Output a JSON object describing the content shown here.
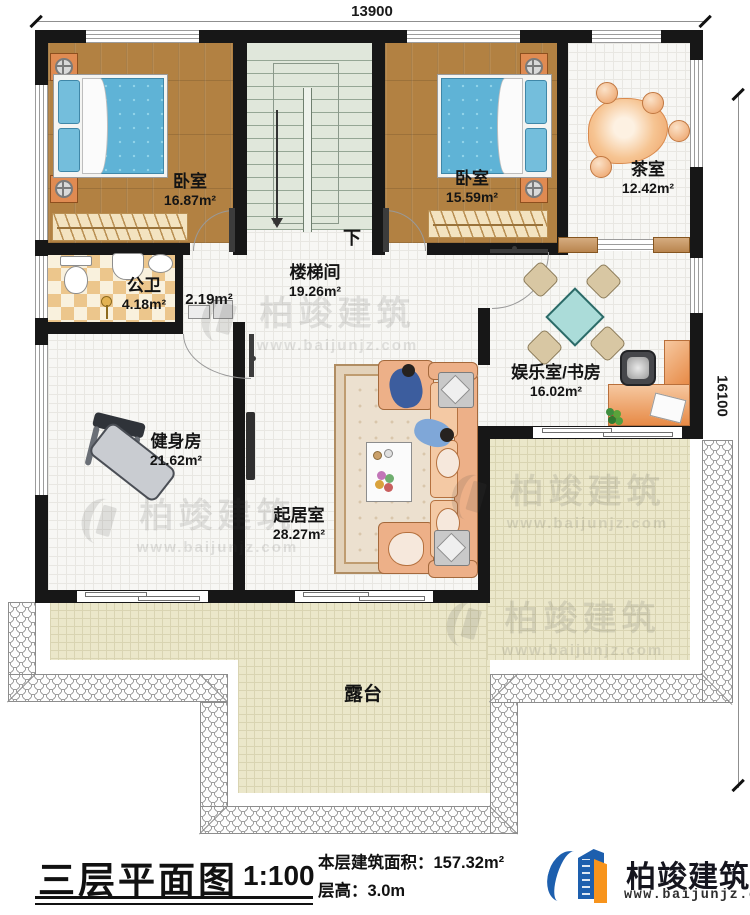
{
  "dimensions": {
    "top": "13900",
    "right": "16100"
  },
  "rooms": {
    "bedroom1": {
      "name": "卧室",
      "area": "16.87m²"
    },
    "bedroom2": {
      "name": "卧室",
      "area": "15.59m²"
    },
    "tea_room": {
      "name": "茶室",
      "area": "12.42m²"
    },
    "stairwell": {
      "name": "楼梯间",
      "area": "19.26m²",
      "down_label": "下"
    },
    "bathroom": {
      "name": "公卫",
      "area": "4.18m²"
    },
    "closet": {
      "area": "2.19m²"
    },
    "gym": {
      "name": "健身房",
      "area": "21.62m²"
    },
    "living_room": {
      "name": "起居室",
      "area": "28.27m²"
    },
    "entertainment": {
      "name": "娱乐室/书房",
      "area": "16.02m²"
    },
    "terrace": {
      "name": "露台"
    }
  },
  "title_block": {
    "title": "三层平面图",
    "scale": "1:100",
    "floor_area_label": "本层建筑面积：",
    "floor_area_value": "157.32m²",
    "floor_height_label": "层高：",
    "floor_height_value": "3.0m",
    "brand": {
      "name": "柏竣建筑",
      "website": "www.baijunjz.com"
    }
  },
  "watermark": {
    "name": "柏竣建筑",
    "website": "www.baijunjz.com"
  },
  "colors": {
    "brand_blue": "#1d5fae",
    "brand_orange": "#f7941d",
    "wall": "#171717"
  }
}
